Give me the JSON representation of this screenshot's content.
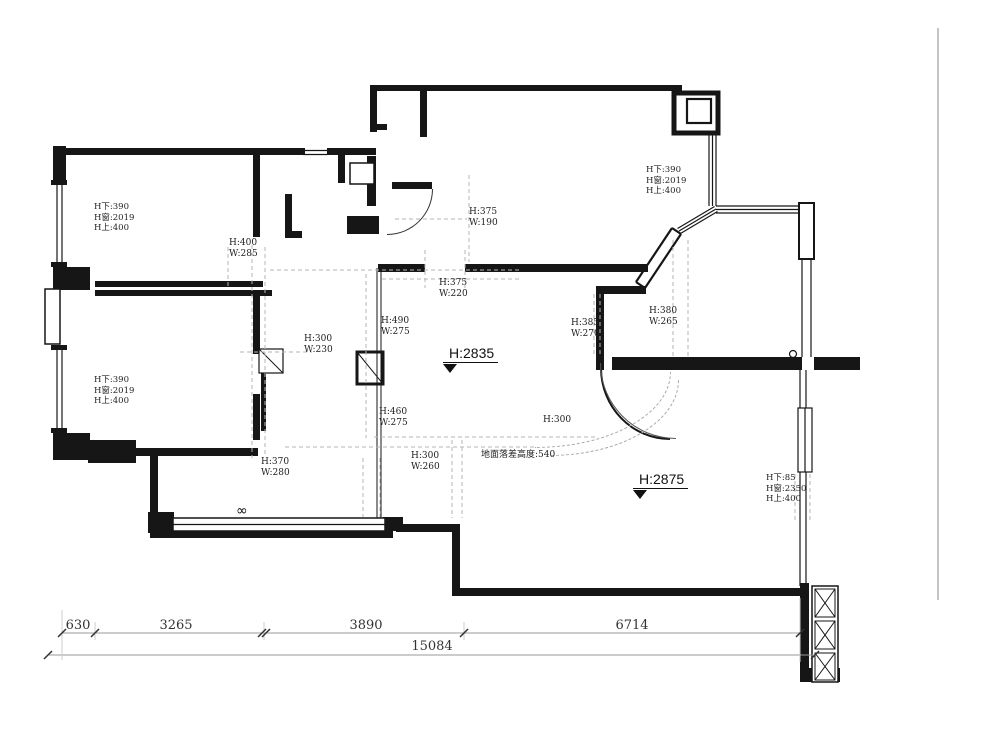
{
  "plan": {
    "window_specs": [
      {
        "l1": "H下:390",
        "l2": "H窗:2019",
        "l3": "H上:400"
      },
      {
        "l1": "H下:390",
        "l2": "H窗:2019",
        "l3": "H上:400"
      },
      {
        "l1": "H下:390",
        "l2": "H窗:2019",
        "l3": "H上:400"
      },
      {
        "l1": "H下:85",
        "l2": "H窗:2350",
        "l3": "H上:400"
      }
    ],
    "openings": [
      {
        "h": "H:400",
        "w": "W:285"
      },
      {
        "h": "H:375",
        "w": "W:190"
      },
      {
        "h": "H:375",
        "w": "W:220"
      },
      {
        "h": "H:490",
        "w": "W:275"
      },
      {
        "h": "H:300",
        "w": "W:230"
      },
      {
        "h": "H:385",
        "w": "W:270"
      },
      {
        "h": "H:380",
        "w": "W:265"
      },
      {
        "h": "H:460",
        "w": "W:275"
      },
      {
        "h": "H:300",
        "w": "W:260"
      },
      {
        "h": "H:370",
        "w": "W:280"
      }
    ],
    "arch_opening": "H:300",
    "floor_note": "地面落差高度:540",
    "height_markers": [
      {
        "label": "H:2835"
      },
      {
        "label": "H:2875"
      }
    ],
    "radiator_symbol": "∞",
    "dimensions": {
      "segments": [
        "630",
        "3265",
        "3890",
        "6714"
      ],
      "total": "15084"
    },
    "line_color": "#161616",
    "dash_color": "#b5b5b5"
  }
}
